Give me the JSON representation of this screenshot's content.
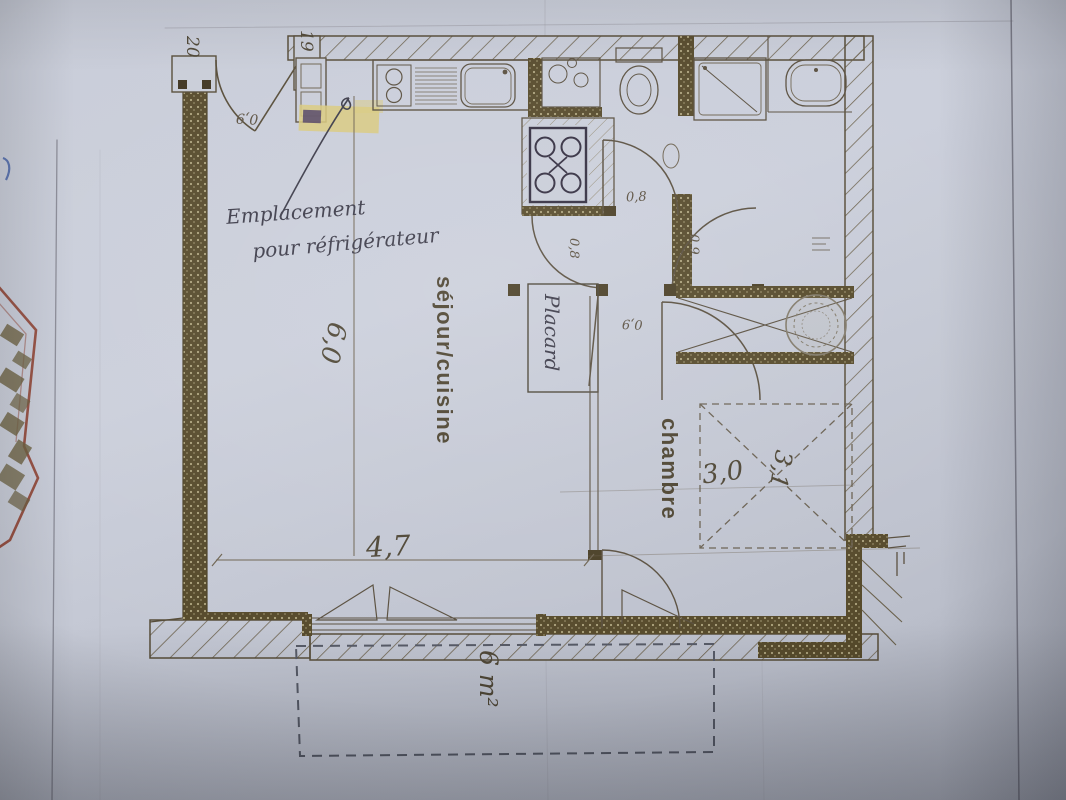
{
  "rooms": {
    "living_kitchen": "séjour/cuisine",
    "bedroom": "chambre"
  },
  "annotations": {
    "fridge_line1": "Emplacement",
    "fridge_line2": "pour réfrigérateur",
    "closet": "Placard"
  },
  "dimensions": {
    "marker_left": "20",
    "marker_entry": "19",
    "entry_door": "0,9",
    "wc_door": "0,8",
    "living_door": "0,8",
    "hall_door": "0,9",
    "bedroom_door": "0,9",
    "living_length": "6,0",
    "living_width": "4,7",
    "bedroom_width": "3,0",
    "bedroom_depth": "3,1",
    "balcony_area": "6 m²"
  },
  "icons": [
    "kitchen-sink-icon",
    "drainboard-icon",
    "two-burner-hob-icon",
    "four-burner-hob-icon",
    "toilet-icon",
    "hand-basin-icon",
    "shower-icon",
    "washbasin-icon",
    "door-arc-icon",
    "sliding-window-icon",
    "wardrobe-cross-icon",
    "bed-outline-icon",
    "circular-stamp-icon",
    "refrigerator-highlight"
  ],
  "colors": {
    "paper": "#c8ccd8",
    "plan_line": "#5a5040",
    "wall_fill": "#564a2b",
    "highlight": "#d9c97c",
    "handwriting_ink": "#3c3b49",
    "red_fragment": "#8d3a28",
    "blue_pen": "#4663a8"
  }
}
